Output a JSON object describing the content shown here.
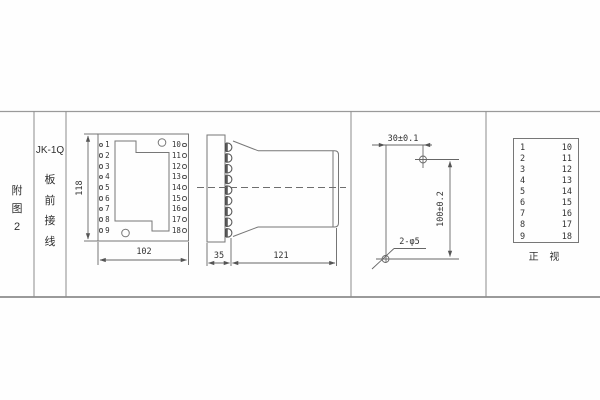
{
  "colors": {
    "line": "#7a7a7a",
    "band_line": "#9a9a9a",
    "text": "#3a3a3a",
    "terminal_dark": "#454545"
  },
  "title_block": {
    "figure_chars": [
      "附",
      "图",
      "2"
    ],
    "model": "JK-1Q",
    "mounting_chars": [
      "板",
      "前",
      "接",
      "线"
    ]
  },
  "front_view": {
    "left_terminals": [
      "1",
      "2",
      "3",
      "4",
      "5",
      "6",
      "7",
      "8",
      "9"
    ],
    "right_terminals": [
      "10",
      "11",
      "12",
      "13",
      "14",
      "15",
      "16",
      "17",
      "18"
    ],
    "height_dim": "118",
    "width_dim": "102"
  },
  "side_view": {
    "flange_dim": "35",
    "body_dim": "121"
  },
  "drill_template": {
    "horizontal_dim": "30±0.1",
    "vertical_dim": "100±0.2",
    "holes_label": "2-φ5"
  },
  "terminal_table": {
    "rows": [
      {
        "left": "1",
        "right": "10"
      },
      {
        "left": "2",
        "right": "11"
      },
      {
        "left": "3",
        "right": "12"
      },
      {
        "left": "4",
        "right": "13"
      },
      {
        "left": "5",
        "right": "14"
      },
      {
        "left": "6",
        "right": "15"
      },
      {
        "left": "7",
        "right": "16"
      },
      {
        "left": "8",
        "right": "17"
      },
      {
        "left": "9",
        "right": "18"
      }
    ],
    "caption": "正 视"
  }
}
